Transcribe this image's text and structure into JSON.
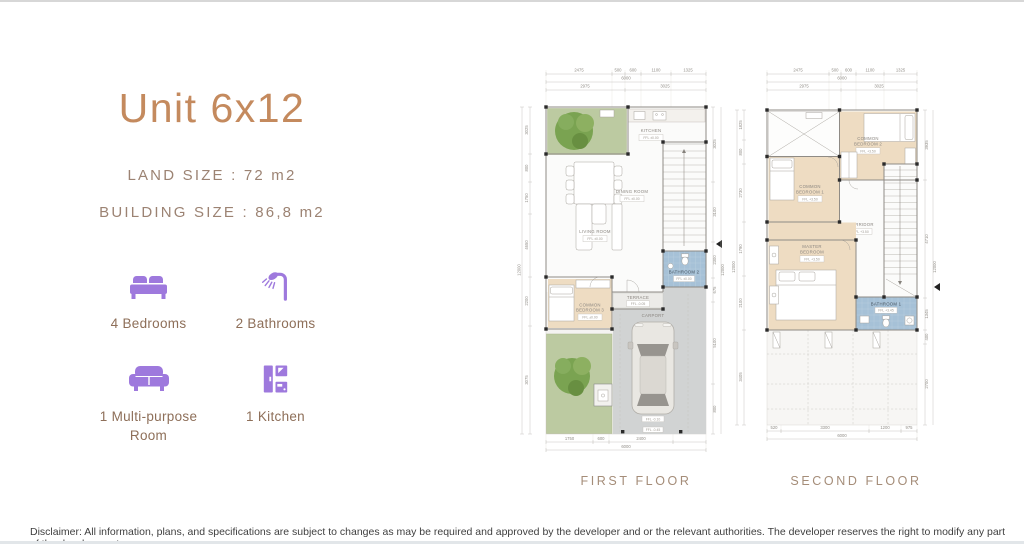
{
  "header": {
    "title": "Unit 6x12",
    "land_size_label": "LAND SIZE : 72 m2",
    "building_size_label": "BUILDING SIZE : 86,8 m2"
  },
  "features": [
    {
      "icon": "bed-icon",
      "label": "4 Bedrooms"
    },
    {
      "icon": "shower-icon",
      "label": "2 Bathrooms"
    },
    {
      "icon": "sofa-icon",
      "label": "1 Multi-purpose Room"
    },
    {
      "icon": "kitchen-icon",
      "label": "1 Kitchen"
    }
  ],
  "first_floor": {
    "title": "FIRST FLOOR",
    "rooms": {
      "kitchen": {
        "name": "KITCHEN",
        "ffl": "FFL ±0.00"
      },
      "dining": {
        "name": "DINING ROOM",
        "ffl": "FFL ±0.00"
      },
      "living": {
        "name": "LIVING ROOM",
        "ffl": "FFL ±0.00"
      },
      "bathroom2": {
        "name": "BATHROOM 2",
        "ffl": "FFL ±0.00"
      },
      "bedroom3": {
        "line1": "COMMON",
        "line2": "BEDROOM 3",
        "ffl": "FFL ±0.00"
      },
      "terrace": {
        "name": "TERRACE",
        "ffl": "FFL -0.05"
      },
      "carport": {
        "name": "CARPORT",
        "ffl": "FFL -0.10"
      },
      "driveway_ffl": "FFL -0.45"
    },
    "dims_top": [
      "2475",
      "500",
      "600",
      "1100",
      "1325"
    ],
    "dim_total": "6000",
    "dims_mid": [
      "2975",
      "3025"
    ],
    "dims_bottom": [
      "1750",
      "600",
      "2400"
    ],
    "dims_left": [
      "3025",
      "800",
      "1750",
      "4650",
      "2200",
      "3075"
    ],
    "dim_left_total": "12000",
    "dims_right": [
      "3025",
      "3100",
      "2300",
      "675",
      "5100",
      "800"
    ],
    "dim_right_total": "12000"
  },
  "second_floor": {
    "title": "SECOND FLOOR",
    "rooms": {
      "bedroom2": {
        "line1": "COMMON",
        "line2": "BEDROOM 2",
        "ffl": "FFL +3.50"
      },
      "bedroom1": {
        "line1": "COMMON",
        "line2": "BEDROOM 1",
        "ffl": "FFL +3.50"
      },
      "master": {
        "line1": "MASTER",
        "line2": "BEDROOM",
        "ffl": "FFL +3.50"
      },
      "corridor": {
        "name": "CORRIDOR",
        "ffl": "FFL +3.50"
      },
      "bathroom1": {
        "name": "BATHROOM 1",
        "ffl": "FFL +3.45"
      }
    },
    "dims_top": [
      "2475",
      "500",
      "600",
      "1100",
      "1325"
    ],
    "dim_total": "6000",
    "dims_mid": [
      "2975",
      "3025"
    ],
    "dims_bottom": [
      "520",
      "3300",
      "1200",
      "975"
    ],
    "dims_left": [
      "1825",
      "800",
      "2730",
      "1790",
      "2100",
      "3405"
    ],
    "dim_left_total": "12000",
    "dims_right": [
      "3935",
      "4710",
      "1345",
      "400",
      "2700"
    ],
    "dim_right_total": "12000"
  },
  "footer": {
    "disclaimer": "Disclaimer: All information, plans, and specifications are subject to changes as may be required and approved by the developer and or the relevant authorities. The developer reserves the right to modify any part of the development"
  },
  "colors": {
    "accent_purple": "#9e79dd",
    "title_brown": "#c48a5e",
    "text_brown": "#9c8373",
    "label_brown": "#8e6f59",
    "plan_beige": "#eedcc2",
    "plan_blue": "#a6c1d7",
    "plan_green": "#bccaa1",
    "plan_gray": "#d1d3d3"
  }
}
